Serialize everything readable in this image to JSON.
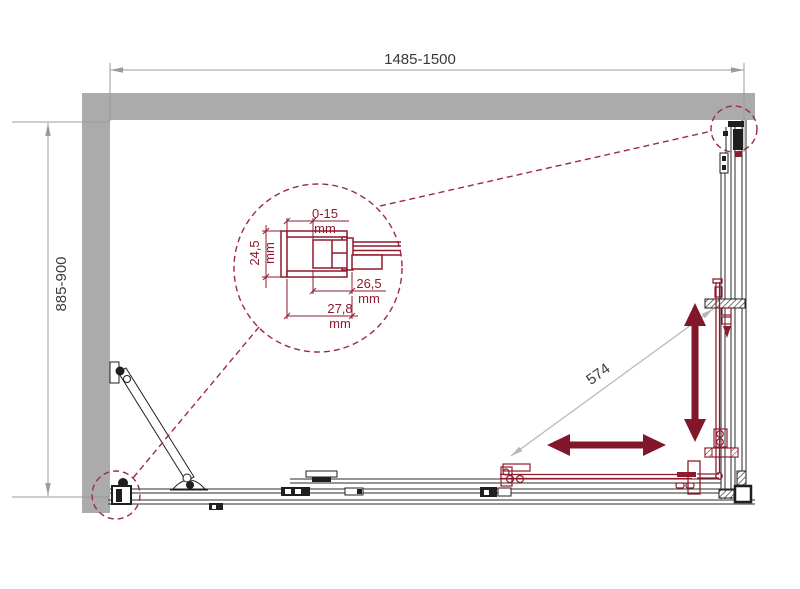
{
  "drawing": {
    "title": "shower-enclosure-technical-drawing",
    "dims": {
      "width_label": "1485-1500",
      "depth_label": "885-900",
      "diagonal_label": "574"
    },
    "detail": {
      "gap_value": "0-15",
      "gap_unit": "mm",
      "profile_depth_value": "24,5",
      "profile_depth_unit": "mm",
      "inner_width_value": "26,5",
      "inner_width_unit": "mm",
      "outer_width_value": "27,8",
      "outer_width_unit": "mm"
    },
    "colors": {
      "wall_gray": "#ababab",
      "frame_black": "#2b2b2b",
      "accent_maroon": "#82172b",
      "detail_maroon": "#8e1b2d",
      "dash_maroon": "#9c2b44",
      "dim_gray": "#9b9b9b",
      "dim_text": "#3a3a3a",
      "diagonal_gray": "#b5b5b5"
    }
  }
}
